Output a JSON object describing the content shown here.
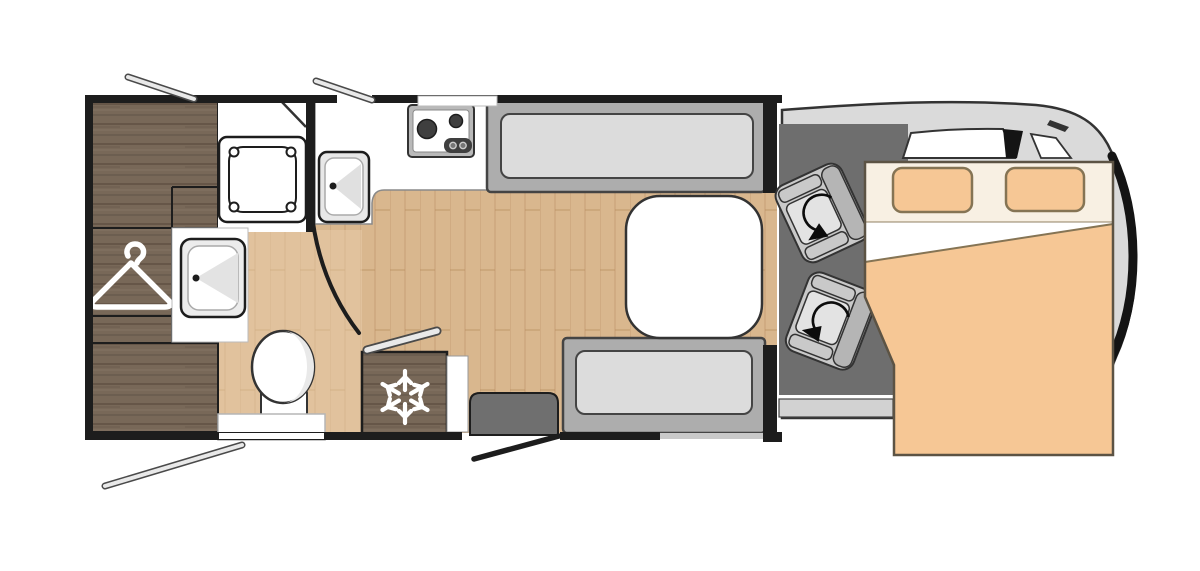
{
  "diagram": {
    "label": "motorhome-floor-plan",
    "view": "top-down"
  },
  "features": [
    "rear-wardrobe",
    "overhead-cabinet",
    "drawer-unit",
    "clothes-hanger-icon",
    "shower-tray",
    "washbasin",
    "toilet",
    "kitchen-counter",
    "kitchen-sink",
    "gas-hob-two-burners",
    "refrigerator",
    "snowflake-icon",
    "dinette-bench-front",
    "dinette-bench-rear",
    "dinette-table",
    "entry-step",
    "entry-door-open",
    "opening-window-top-left",
    "opening-window-top-kitchen",
    "opening-window-rear-bottom",
    "swivel-seat-driver",
    "swivel-seat-passenger",
    "rotation-arrow-icon",
    "drop-down-bed",
    "bed-pillows",
    "cab-windshield",
    "vehicle-cab"
  ],
  "colors": {
    "background": "#ffffff",
    "wall": "#1d1d1d",
    "outline": "#333333",
    "floor_base": "#d9b78e",
    "bath_tint": "#ecd0b0",
    "wood_base": "#786858",
    "white": "#ffffff",
    "bench_frame": "#adadad",
    "bench_cushion": "#dcdcdc",
    "bench_stroke": "#444444",
    "table_fill": "#ffffff",
    "step_fill": "#6f6f6f",
    "snowflake": "#ffffff",
    "hanger": "#ffffff",
    "cab_body": "#dadada",
    "cab_dark": "#6e6e6e",
    "cab_trim": "#141414",
    "sill": "#d2d2d2",
    "seat_base": "#c9c9c9",
    "seat_back": "#b5b5b5",
    "seat_cushion": "#e3e3e3",
    "arrow": "#0c0c0c",
    "bed_mattress": "#f6c795",
    "bed_sheet": "#f8f0e3",
    "bed_stroke": "#5c5344",
    "pillow_stroke": "#857454",
    "chrome": "#e9e9e9",
    "chrome_dark": "#4a4a4a",
    "appliance_dark": "#3f3f3f",
    "appliance_frame": "#b9b9b9",
    "window_gray": "#c9c9c9"
  }
}
